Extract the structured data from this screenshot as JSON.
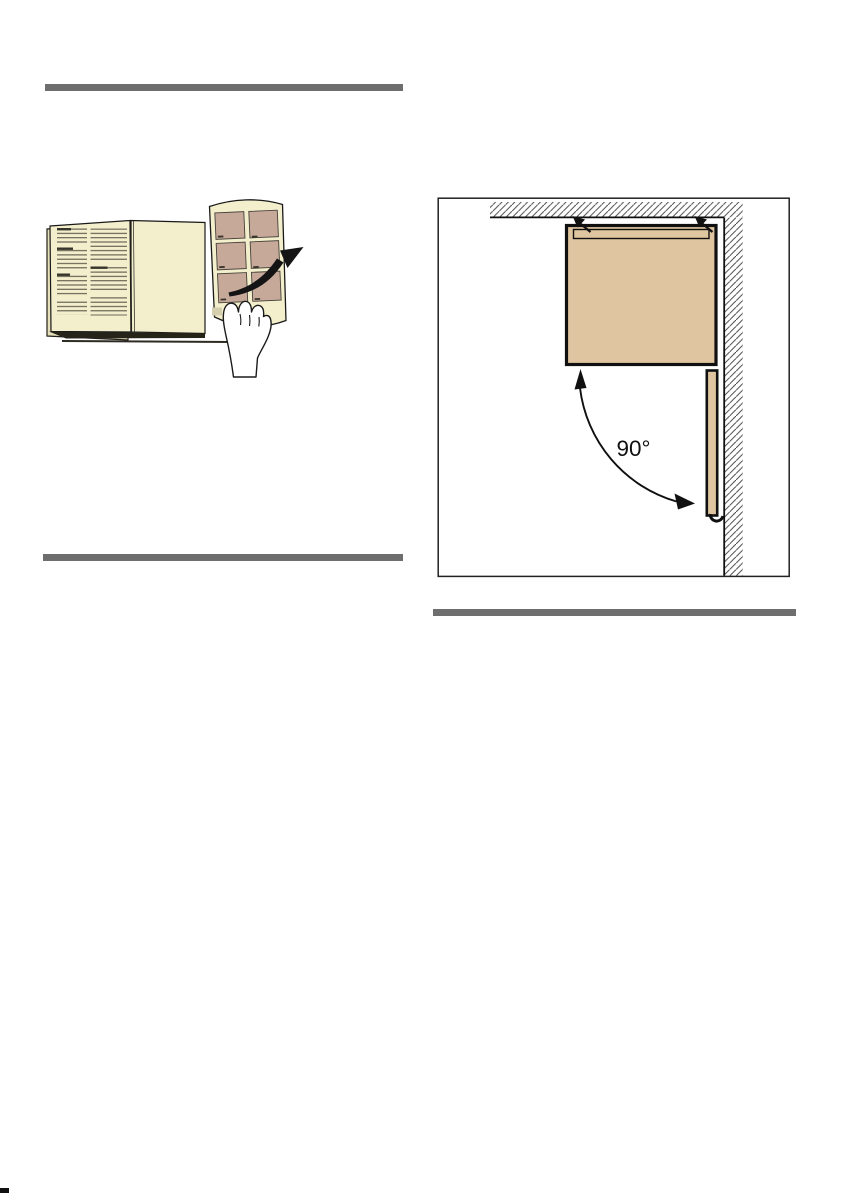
{
  "document": {
    "kind": "appliance-manual-page",
    "angle_label": "90°"
  },
  "colors": {
    "divider_gray": "#6e6e6e",
    "book_page_cream": "#f3efcc",
    "book_back_cream": "#e6e1ba",
    "panel_tan": "#c7a99a",
    "appliance_tan": "#dfc6a0",
    "line_black": "#111111",
    "hatch_gray": "#3d3d3d"
  },
  "icons": {
    "book_illustration": "page-turn-illustration",
    "turn_arrow": "page-turn-arrow",
    "hand": "hand-turning-page",
    "diagram": "door-open-90-degrees-top-view",
    "wall": "hatched-wall",
    "alignment_arrows": "wall-alignment-arrows",
    "swing_arc": "door-swing-arc-arrow"
  }
}
